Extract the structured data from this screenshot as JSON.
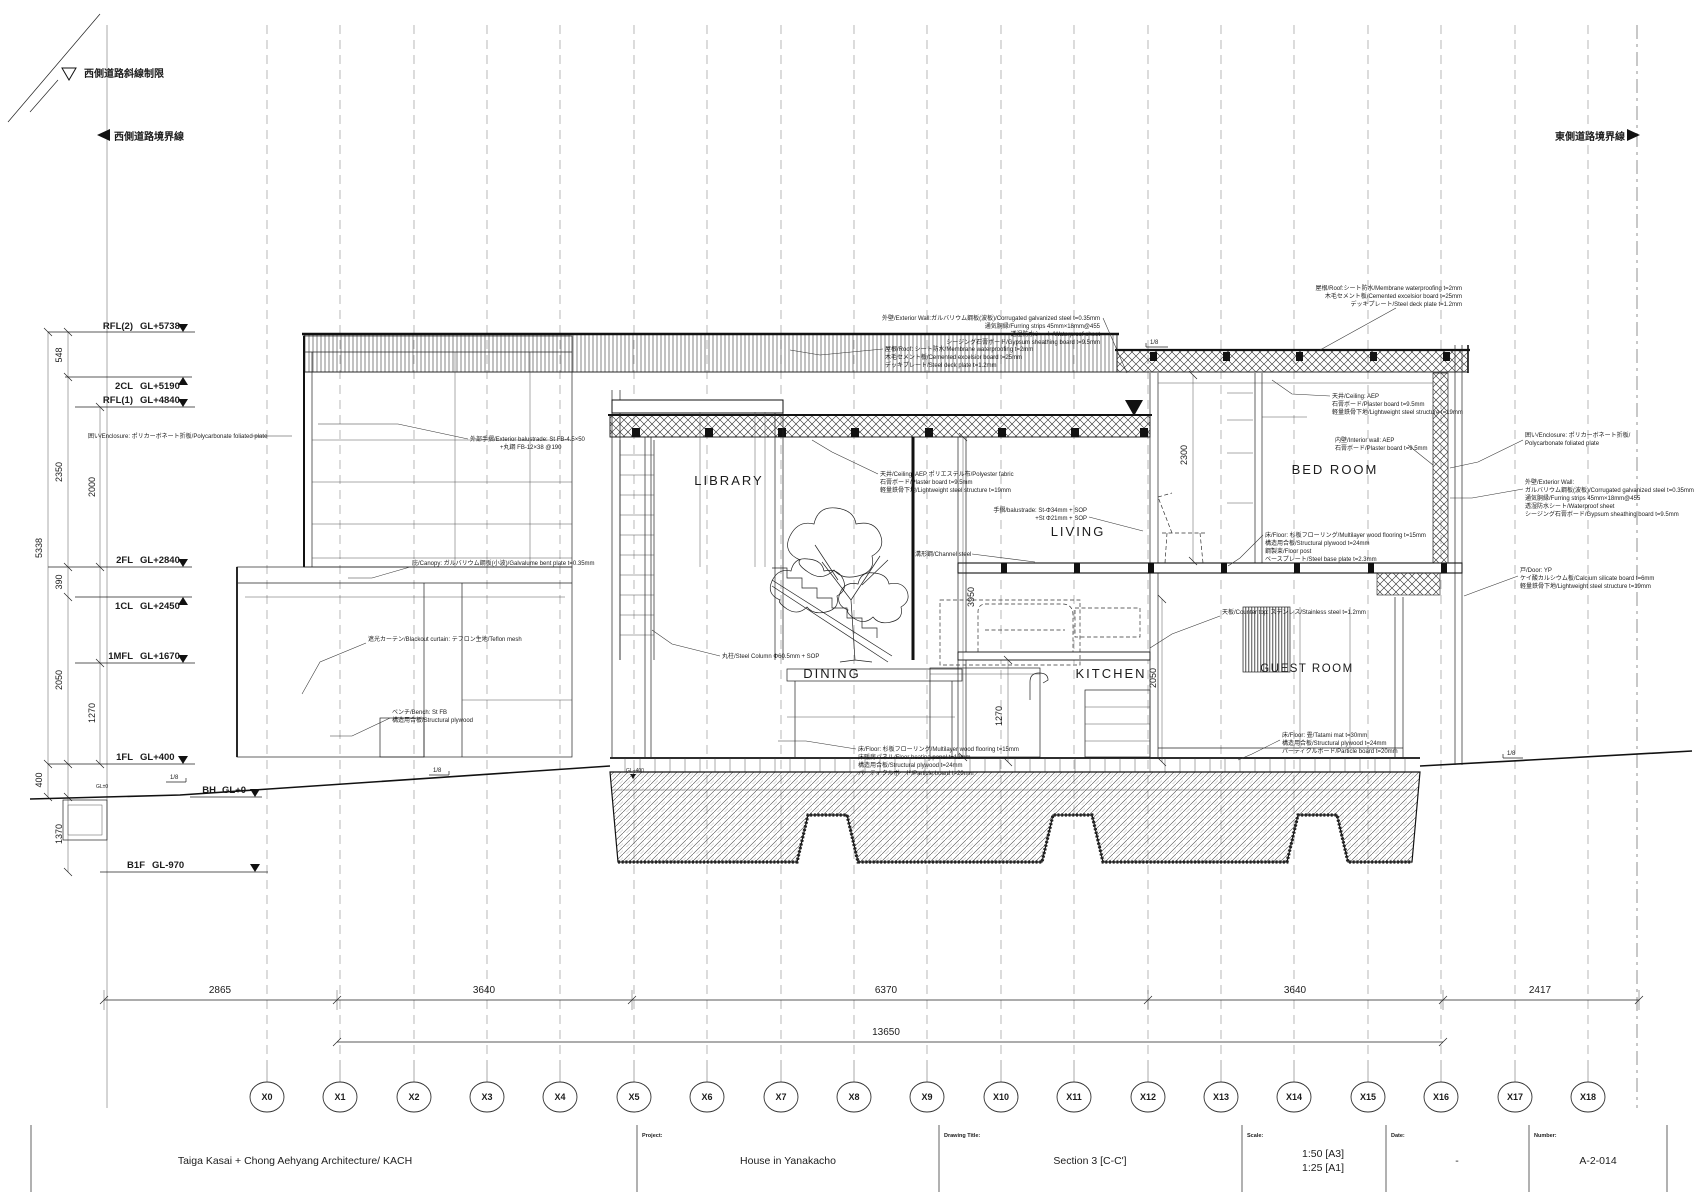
{
  "site": {
    "west_setback": "西側道路斜線制限",
    "west_boundary": "西側道路境界線",
    "east_boundary": "東側道路境界線"
  },
  "levels": [
    {
      "name": "RFL(2)",
      "elev": "GL+5738"
    },
    {
      "name": "2CL",
      "elev": "GL+5190"
    },
    {
      "name": "RFL(1)",
      "elev": "GL+4840"
    },
    {
      "name": "2FL",
      "elev": "GL+2840"
    },
    {
      "name": "1CL",
      "elev": "GL+2450"
    },
    {
      "name": "1MFL",
      "elev": "GL+1670"
    },
    {
      "name": "1FL",
      "elev": "GL+400"
    },
    {
      "name": "BH",
      "elev": "GL+0"
    },
    {
      "name": "B1F",
      "elev": "GL-970"
    }
  ],
  "left_dims": [
    "548",
    "2350",
    "2000",
    "5338",
    "390",
    "2050",
    "1270",
    "400",
    "1370"
  ],
  "interior_dims": [
    "3950",
    "1270",
    "2050",
    "2300"
  ],
  "slope_marker": "1/8",
  "ground": {
    "gl400": "GL+400",
    "gl0": "GL±0"
  },
  "rooms": {
    "library": "LIBRARY",
    "living": "LIVING",
    "dining": "DINING",
    "kitchen": "KITCHEN",
    "bedroom": "BED ROOM",
    "guestroom": "GUEST ROOM"
  },
  "grid": {
    "labels": [
      "X0",
      "X1",
      "X2",
      "X3",
      "X4",
      "X5",
      "X6",
      "X7",
      "X8",
      "X9",
      "X10",
      "X11",
      "X12",
      "X13",
      "X14",
      "X15",
      "X16",
      "X17",
      "X18"
    ]
  },
  "bottom_dims": {
    "segments": [
      "2865",
      "3640",
      "6370",
      "3640",
      "2417"
    ],
    "overall": "13650"
  },
  "annotations": {
    "roof_right": {
      "l1": "屋根/Roof:シート防水/Membrane waterproofing t=2mm",
      "l2": "木毛セメント板/Cemented excelsior board t=25mm",
      "l3": "デッキプレート/Steel deck plate t=1.2mm"
    },
    "ext_wall_top": {
      "l1": "外壁/Exterior Wall:ガルバリウム鋼板(波板)/Corrugated galvanized steel t=0.35mm",
      "l2": "通気胴縁/Furring strips 45mm×18mm@455",
      "l3": "透湿防水シート/Waterproof sheet",
      "l4": "シージング石膏ボード/Gypsum sheathing board t=9.5mm"
    },
    "roof_left": {
      "l1": "屋根/Roof: シート防水/Membrane waterproofing t=2mm",
      "l2": "木毛セメント板/Cemented excelsior board t=25mm",
      "l3": "デッキプレート/Steel deck plate t=1.2mm"
    },
    "ceiling_center": {
      "l1": "天井/Ceiling: AEP ポリエステル布/Polyester fabric",
      "l2": "石膏ボード/Plaster board t=9.5mm",
      "l3": "軽量鉄骨下地/Lightweight steel structure t=19mm"
    },
    "balustrade_living": {
      "l1": "手摺/balustrade: St-Φ34mm + SOP",
      "l2": "+St Φ21mm + SOP"
    },
    "channel_steel": {
      "l1": "溝形鋼/Channel steel"
    },
    "ext_balustrade": {
      "l1": "外部手摺/Exterior balustrade: St FB-4.5×50",
      "l2": "+丸鋼 FB-12×38 @190"
    },
    "canopy": {
      "l1": "庇/Canopy: ガルバリウム鋼板(小波)/Galvalume bent plate t=0.35mm"
    },
    "curtain": {
      "l1": "遮光カーテン/Blackout curtain: テフロン生地/Teflon mesh"
    },
    "bench": {
      "l1": "ベンチ/Bench: St FB",
      "l2": "構造用合板/Structural plywood"
    },
    "column": {
      "l1": "丸柱/Steel Column Φ60.5mm + SOP"
    },
    "floor_dining": {
      "l1": "床/Floor: 杉板フローリング/Multilayer wood flooring t=15mm",
      "l2": "床暖房パネル/Floor heating panel t=12mm",
      "l3": "構造用合板/Structural plywood t=24mm",
      "l4": "パーティクルボード/Particle board t=20mm"
    },
    "counter": {
      "l1": "天板/Counter top: ステンレス/Stainless steel t=1.2mm"
    },
    "bedroom_ceiling": {
      "l1": "天井/Ceiling: AEP",
      "l2": "石膏ボード/Plaster board t=9.5mm",
      "l3": "軽量鉄骨下地/Lightweight steel structure t=19mm"
    },
    "bedroom_wall": {
      "l1": "内壁/Interior wall: AEP",
      "l2": "石膏ボード/Plaster board t=9.5mm"
    },
    "bedroom_floor": {
      "l1": "床/Floor: 杉板フローリング/Multilayer wood flooring t=15mm",
      "l2": "構造用合板/Structural plywood t=24mm",
      "l3": "鋼製束/Floor post",
      "l4": "ベースプレート/Steel base plate t=2.3mm"
    },
    "enclosure_east": {
      "l1": "囲い/Enclosure: ポリカーボネート折板/",
      "l2": "Polycarbonate foliated plate"
    },
    "ext_wall_east": {
      "l1": "外壁/Exterior Wall:",
      "l2": "ガルバリウム鋼板(波板)/Corrugated galvanized steel t=0.35mm",
      "l3": "通気胴縁/Furring strips 45mm×18mm@455",
      "l4": "透湿防水シート/Waterproof sheet",
      "l5": "シージング石膏ボード/Gypsum sheathing board t=9.5mm"
    },
    "door_east": {
      "l1": "戸/Door: YP",
      "l2": "ケイ酸カルシウム板/Calcium silicate board t=6mm",
      "l3": "軽量鉄骨下地/Lightweight steel structure t=19mm"
    },
    "guest_floor": {
      "l1": "床/Floor: 畳/Tatami mat t=30mm",
      "l2": "構造用合板/Structural plywood t=24mm",
      "l3": "パーティクルボード/Particle board t=20mm"
    },
    "enclosure_west": {
      "l1": "囲い/Enclosure: ポリカーボネート折板/Polycarbonate foliated plate"
    }
  },
  "title_block": {
    "architect": "Taiga Kasai + Chong Aehyang Architecture/ KACH",
    "project_label": "Project:",
    "project": "House in Yanakacho",
    "drawing_title_label": "Drawing Title:",
    "drawing_title": "Section 3 [C-C']",
    "scale_label": "Scale:",
    "scale_a3": "1:50 [A3]",
    "scale_a1": "1:25 [A1]",
    "date_label": "Date:",
    "date": "-",
    "number_label": "Number:",
    "number": "A-2-014"
  }
}
